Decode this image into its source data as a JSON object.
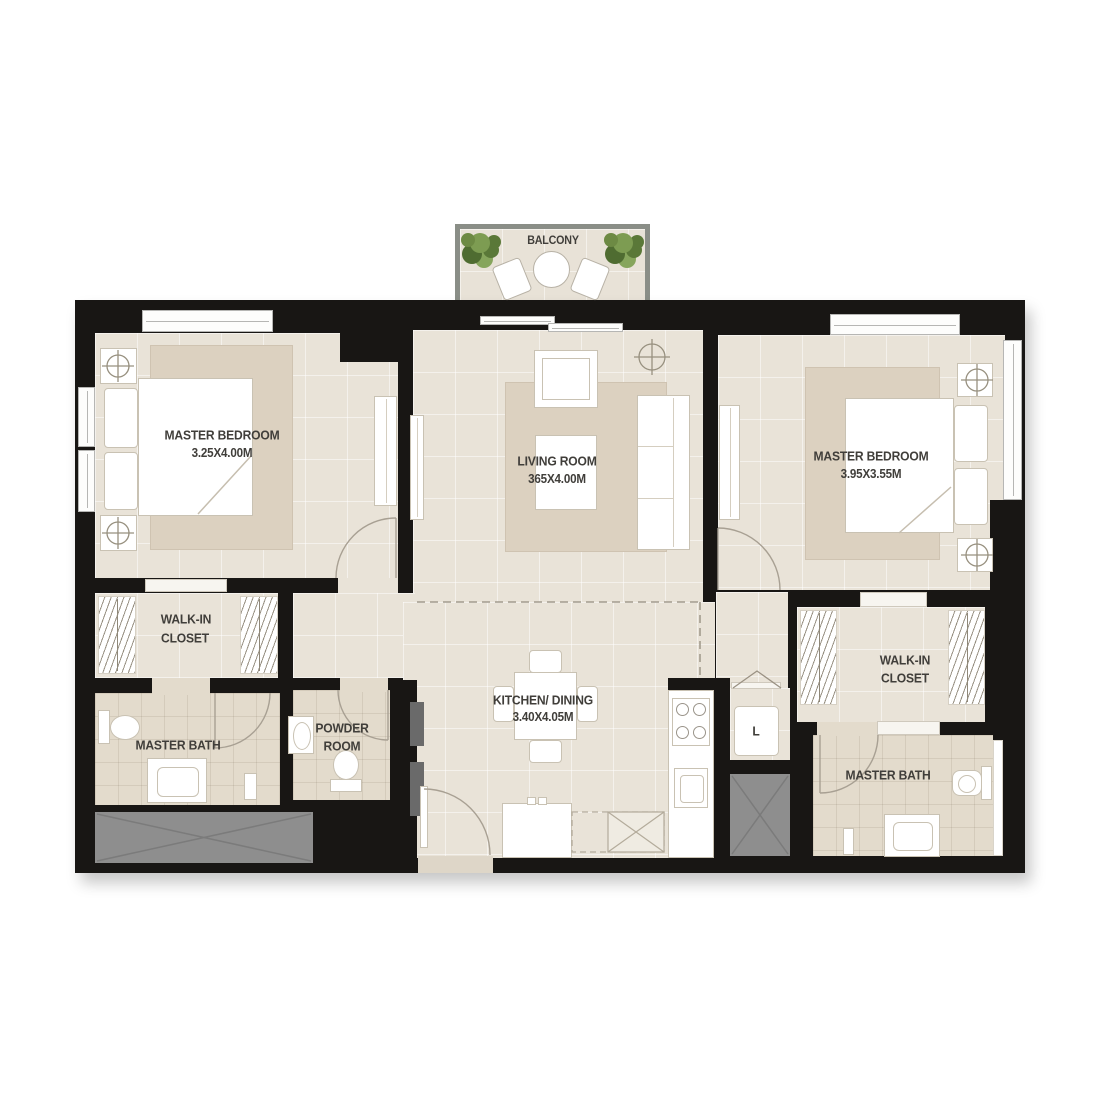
{
  "balcony": {
    "label": "BALCONY"
  },
  "rooms": {
    "bedroom_left": {
      "name": "MASTER BEDROOM",
      "dims": "3.25X4.00M"
    },
    "living": {
      "name": "LIVING ROOM",
      "dims": "365X4.00M"
    },
    "bedroom_right": {
      "name": "MASTER BEDROOM",
      "dims": "3.95X3.55M"
    },
    "closet_left": {
      "line1": "WALK-IN",
      "line2": "CLOSET"
    },
    "bath_left": {
      "name": "MASTER BATH"
    },
    "powder": {
      "line1": "POWDER",
      "line2": "ROOM"
    },
    "kitchen": {
      "name": "KITCHEN/ DINING",
      "dims": "3.40X4.05M"
    },
    "laundry": {
      "label": "L"
    },
    "closet_right": {
      "line1": "WALK-IN",
      "line2": "CLOSET"
    },
    "bath_right": {
      "name": "MASTER BATH"
    }
  },
  "colors": {
    "wall": "#181614",
    "floor": "#e9e3d8",
    "rug": "#dcd1c0",
    "bath_floor": "#e3dbcc",
    "shaft_gray": "#8e8e8e",
    "balcony_wall": "#8a8e87",
    "plant_green": "#6d8a44",
    "label_text": "#403e3a"
  }
}
